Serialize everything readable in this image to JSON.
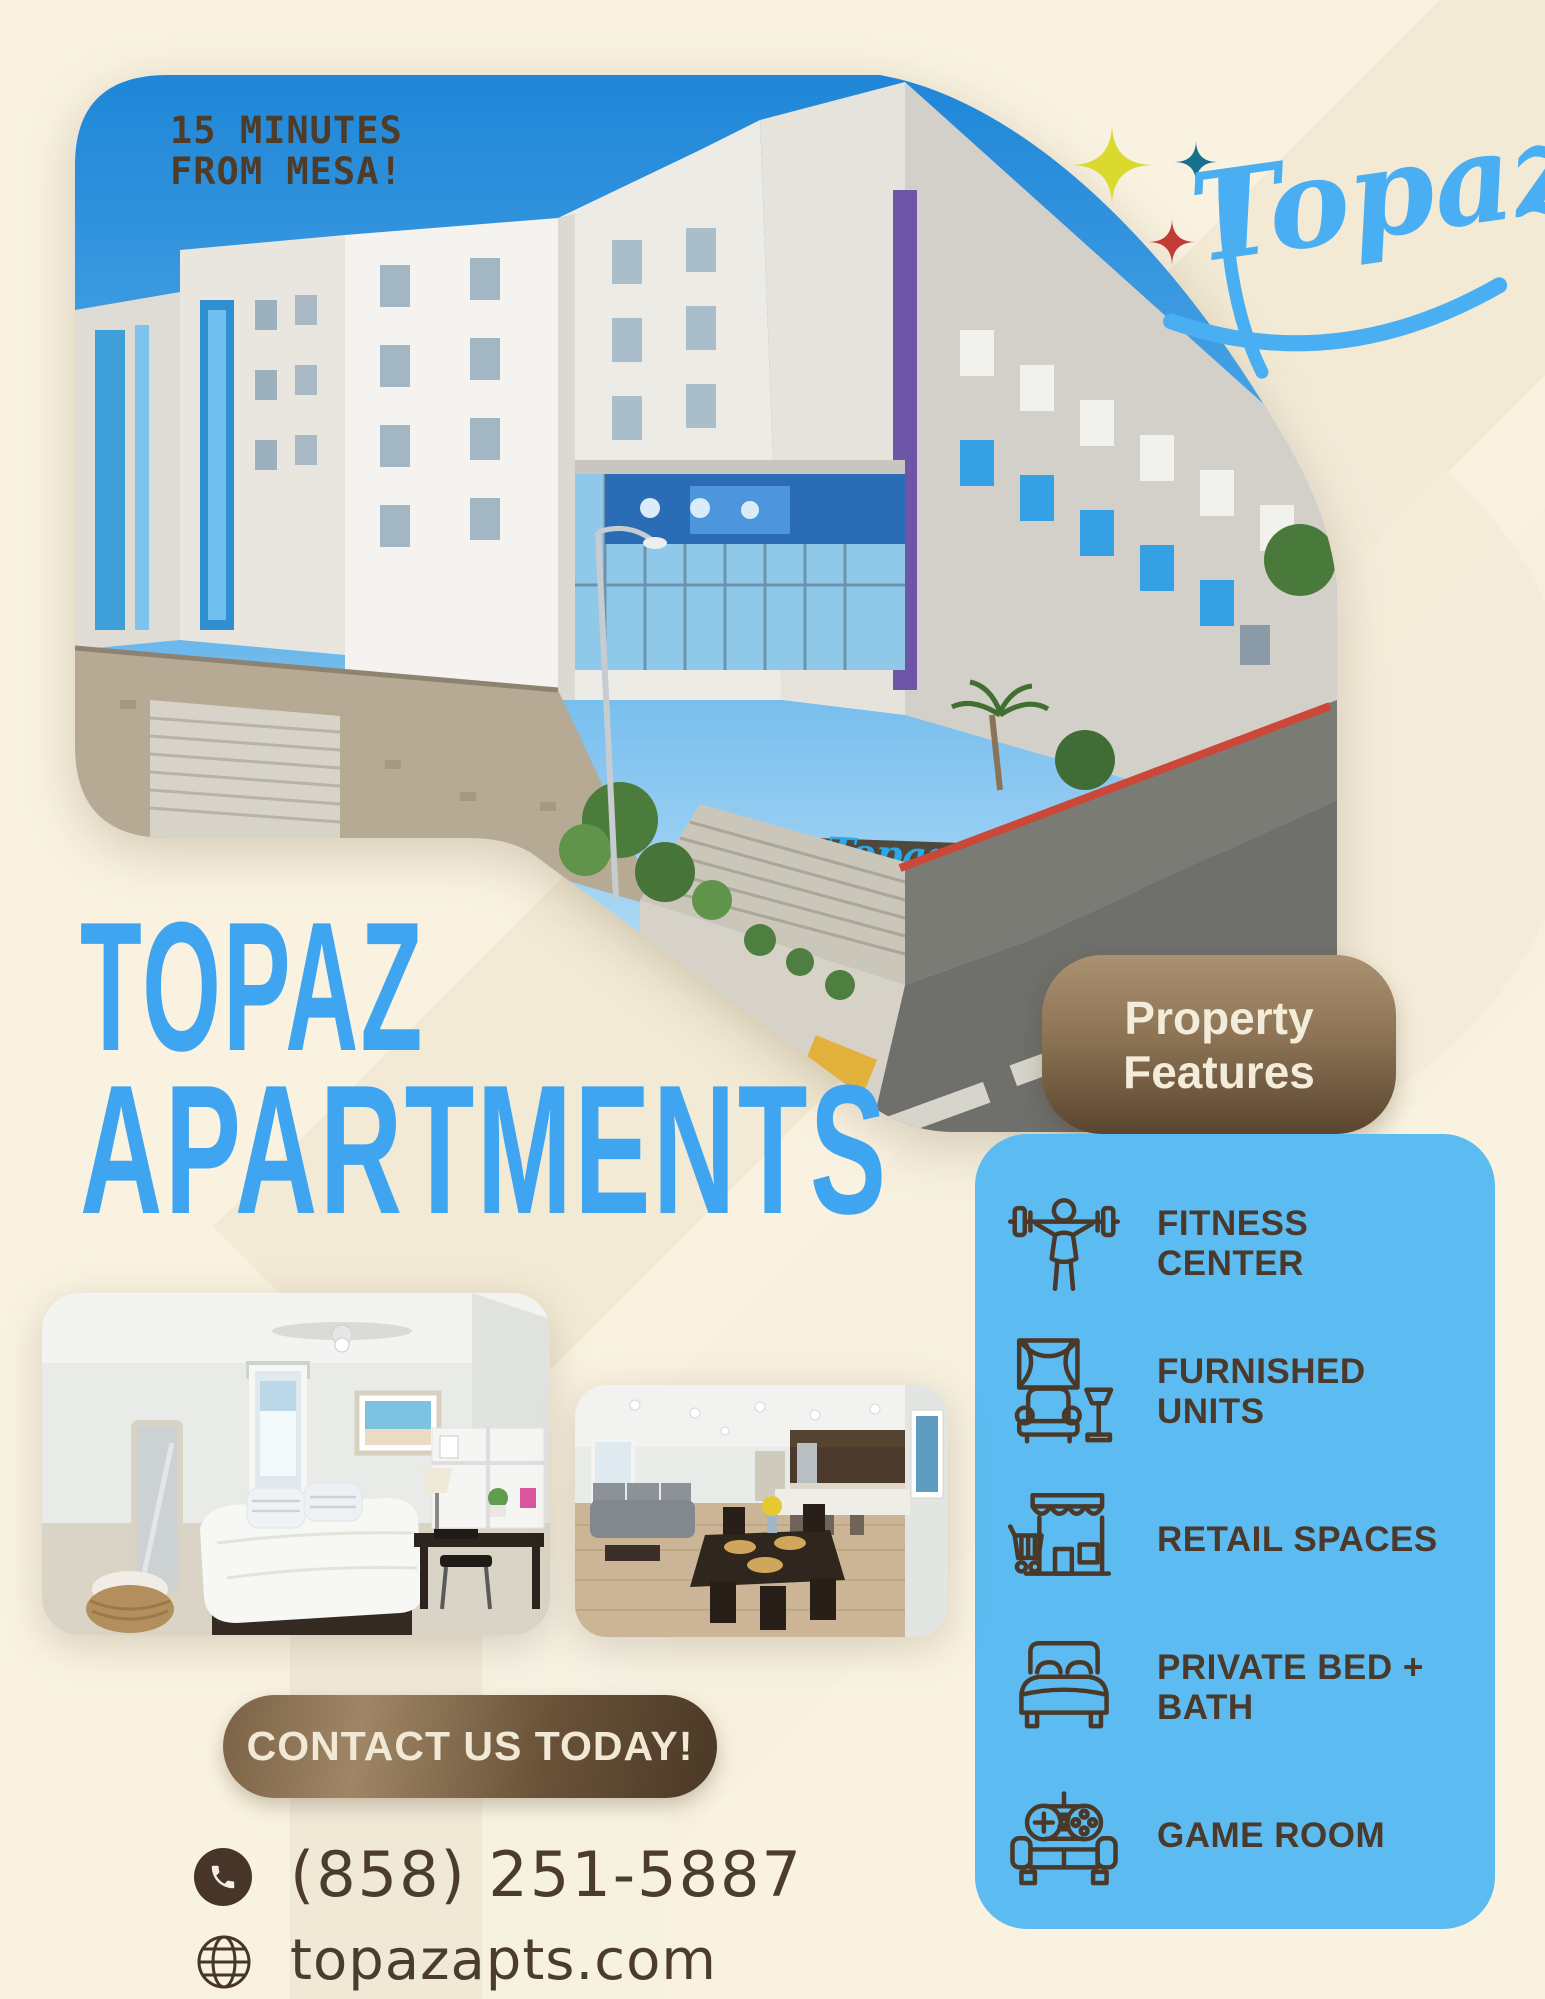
{
  "hero": {
    "tagline_line1": "15 MINUTES",
    "tagline_line2": "FROM MESA!",
    "sign_text": "Topaz"
  },
  "logo": {
    "text": "Topaz",
    "color": "#4aaef3",
    "sparkle_yellow": "#d9d92e",
    "sparkle_teal": "#16718e",
    "sparkle_red": "#c23b35"
  },
  "title": {
    "line1": "TOPAZ",
    "line2": "APARTMENTS",
    "color": "#3fa5f0"
  },
  "features": {
    "badge_line1": "Property",
    "badge_line2": "Features",
    "panel_color": "#5cbbf1",
    "items": [
      {
        "icon": "dumbbell-icon",
        "label": "FITNESS CENTER"
      },
      {
        "icon": "armchair-icon",
        "label": "FURNISHED UNITS"
      },
      {
        "icon": "storefront-icon",
        "label": "RETAIL SPACES"
      },
      {
        "icon": "bed-icon",
        "label": "PRIVATE BED + BATH"
      },
      {
        "icon": "gamepad-icon",
        "label": "GAME ROOM"
      }
    ]
  },
  "contact": {
    "pill_label": "CONTACT US TODAY!",
    "phone": "(858) 251-5887",
    "website": "topazapts.com"
  },
  "colors": {
    "background_cream": "#f9f2e0",
    "heading_blue": "#3fa5f0",
    "panel_blue": "#5cbbf1",
    "text_brown": "#4a3829",
    "badge_brown_top": "#ab9170",
    "badge_brown_bottom": "#5a452f"
  }
}
